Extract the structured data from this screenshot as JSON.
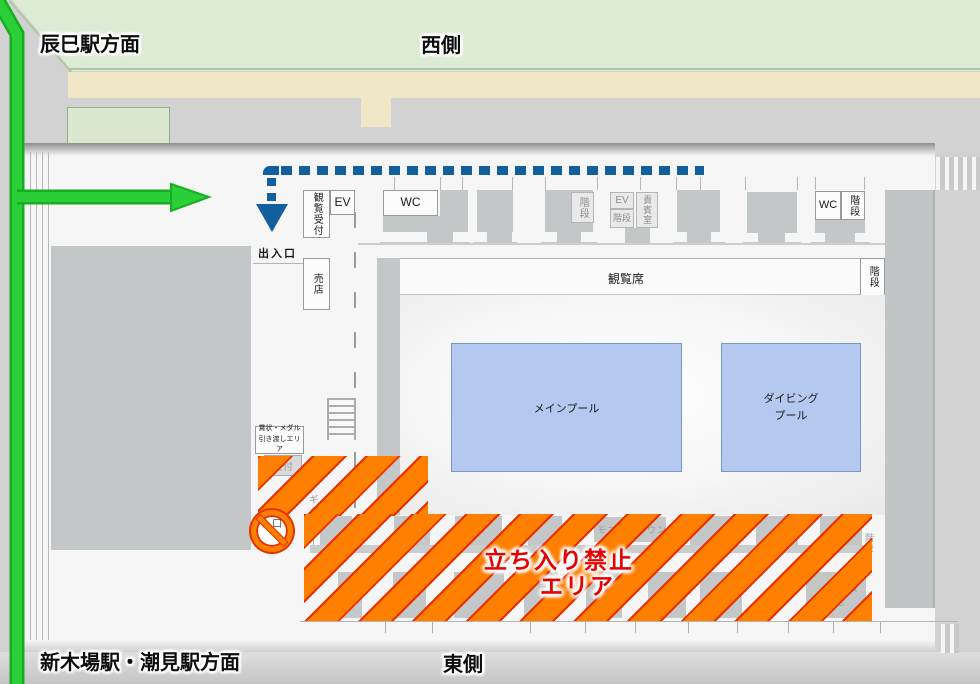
{
  "directions": {
    "north_station": "辰巳駅方面",
    "west_side": "西側",
    "south_stations": "新木場駅・潮見駅方面",
    "east_side": "東側"
  },
  "entrance": {
    "label": "出入口"
  },
  "rooms": {
    "viewing_reception": "観覧受付",
    "elevator_west": "EV",
    "toilet_west": "WC",
    "shop": "売店",
    "stairs_center": "階段",
    "elevator_center": "EV",
    "stairs_center2": "階段",
    "vip_room": "貴賓室",
    "toilet_northeast": "WC",
    "stairs_northeast": "階段",
    "stairs_east": "階段",
    "spectator_seats": "観覧席",
    "main_pool": "メインプール",
    "diving_pool_line1": "ダイビング",
    "diving_pool_line2": "プール",
    "medal_area_line1": "賞状・メダル",
    "medal_area_line2": "引き渡しエリア"
  },
  "restricted_area": {
    "line1": "立ち入り禁止",
    "line2": "エリア"
  },
  "ghost_rooms": {
    "reception": "受付",
    "entrance": "入口",
    "gallery": "ギャラリー",
    "monitor_lounge": "モニターラウンジ",
    "stairs_a": "階段",
    "toilet": "WC",
    "stairs_b": "階段"
  },
  "colors": {
    "route_green": "#2bd039",
    "route_blue": "#135f9e",
    "hazard_orange": "#ff7f00",
    "hazard_border_red": "#e83000",
    "warning_text_red": "#e60000",
    "pool_fill": "#b5c8ef",
    "park_green": "#dcebd3",
    "road_beige": "#f0e7c6"
  }
}
